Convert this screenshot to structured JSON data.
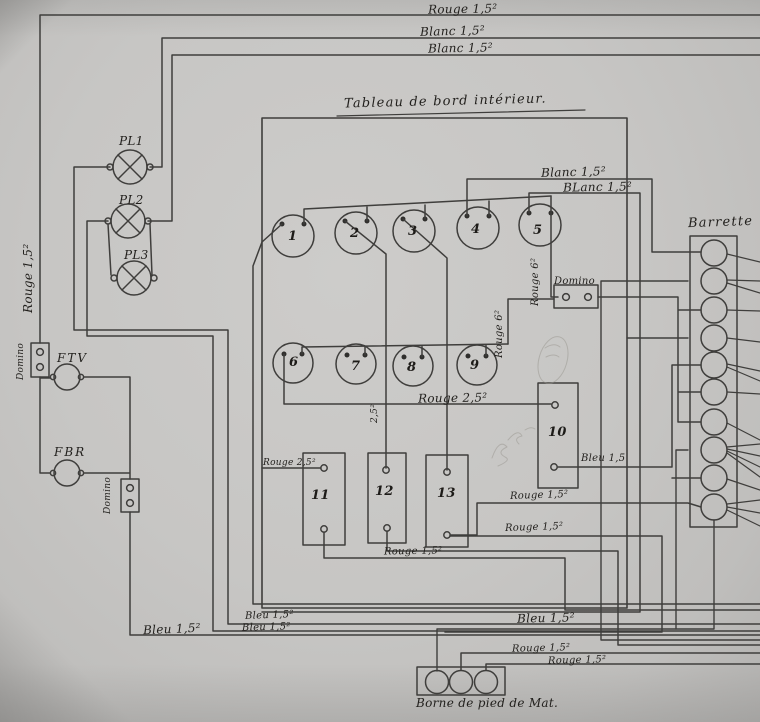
{
  "title": "Tableau de bord intérieur.",
  "components": {
    "lamps": [
      "PL1",
      "PL2",
      "PL3"
    ],
    "fuses": [
      "FTV",
      "FBR"
    ],
    "switches": [
      "1",
      "2",
      "3",
      "4",
      "5",
      "6",
      "7",
      "8",
      "9"
    ],
    "blocks": [
      "10",
      "11",
      "12",
      "13"
    ],
    "barrette": "Barrette",
    "borne": "Borne de pied de Mat."
  },
  "labels": {
    "domino": "Domino",
    "top_rouge": "Rouge 1,5²",
    "top_blanc_1": "Blanc 1,5²",
    "top_blanc_2": "Blanc 1,5²",
    "left_rouge_vertical": "Rouge 1,5²",
    "blanc_right_1": "Blanc 1,5²",
    "blanc_right_2": "BLanc 1,5²",
    "rouge6_switch5": "Rouge 6²",
    "rouge6_switch9": "Rouge 6²",
    "rouge25_main": "Rouge 2,5²",
    "rouge25_block11": "Rouge 2,5²",
    "section25_vertical": "2,5²",
    "bleu15_block10": "Bleu 1,5",
    "rouge15_mid1": "Rouge 1,5²",
    "rouge15_mid2": "Rouge 1,5²",
    "rouge15_bottom_blocks": "Rouge 1,5²",
    "bleu15_left_1": "Bleu 1,5²",
    "bleu15_left_2": "Bleu 1,5²",
    "bleu15_left_3": "Bleu 1,5²",
    "bleu15_center": "Bleu 1,5²",
    "rouge15_borne_1": "Rouge 1,5²",
    "rouge15_borne_2": "Rouge 1,5²"
  },
  "ink_color": "#3f3e3c"
}
